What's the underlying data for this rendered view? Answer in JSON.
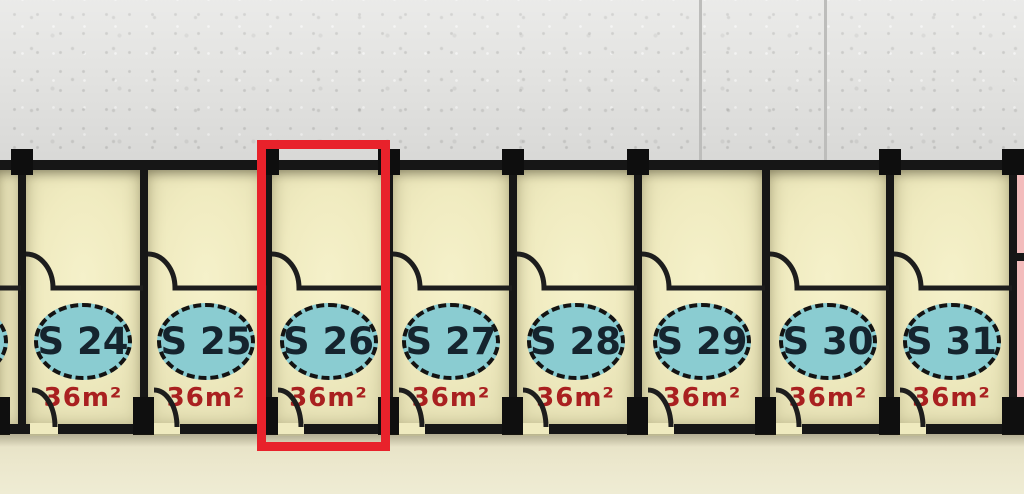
{
  "units": [
    {
      "label": "S 24",
      "area": "36m²"
    },
    {
      "label": "S 25",
      "area": "36m²"
    },
    {
      "label": "S 26",
      "area": "36m²"
    },
    {
      "label": "S 27",
      "area": "36m²"
    },
    {
      "label": "S 28",
      "area": "36m²"
    },
    {
      "label": "S 29",
      "area": "36m²"
    },
    {
      "label": "S 30",
      "area": "36m²"
    },
    {
      "label": "S 31",
      "area": "36m²"
    }
  ],
  "highlight": {
    "unit_label": "S 26",
    "box_color": "#e8222b"
  },
  "colors": {
    "unit_floor": "#f0ebc0",
    "corridor_floor": "#ebe7cc",
    "exterior_concrete": "#e4e4e2",
    "wall": "#161616",
    "badge_fill": "#8accd1",
    "badge_text": "#15242e",
    "area_text": "#a92020",
    "adjacent_right_floor": "#f3bcbc"
  }
}
